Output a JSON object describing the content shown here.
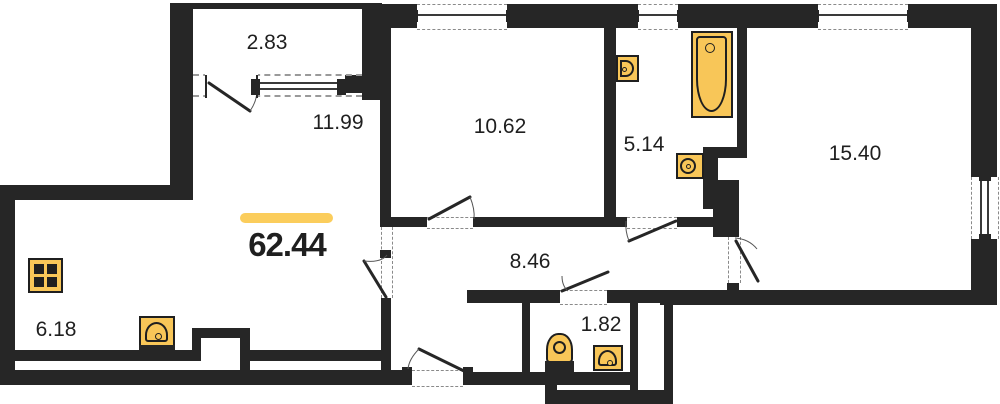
{
  "title": "Apartment floor plan",
  "total": {
    "area": "62.44"
  },
  "rooms": [
    {
      "name": "balcony",
      "area": "2.83"
    },
    {
      "name": "living-room",
      "area": "11.99"
    },
    {
      "name": "bedroom-1",
      "area": "10.62"
    },
    {
      "name": "bathroom",
      "area": "5.14"
    },
    {
      "name": "bedroom-2",
      "area": "15.40"
    },
    {
      "name": "hallway",
      "area": "8.46"
    },
    {
      "name": "kitchen-corner",
      "area": "6.18"
    },
    {
      "name": "wc",
      "area": "1.82"
    }
  ],
  "fixtures": [
    "bathtub",
    "bathroom-sink",
    "bathroom-toilet",
    "wc-toilet",
    "wc-sink",
    "kitchen-stove",
    "kitchen-sink"
  ],
  "colors": {
    "wall": "#262626",
    "fixture_fill": "#F8C658",
    "accent_bar": "#FBCD5C",
    "background": "#FFFFFF",
    "text": "#1F1F1F"
  }
}
